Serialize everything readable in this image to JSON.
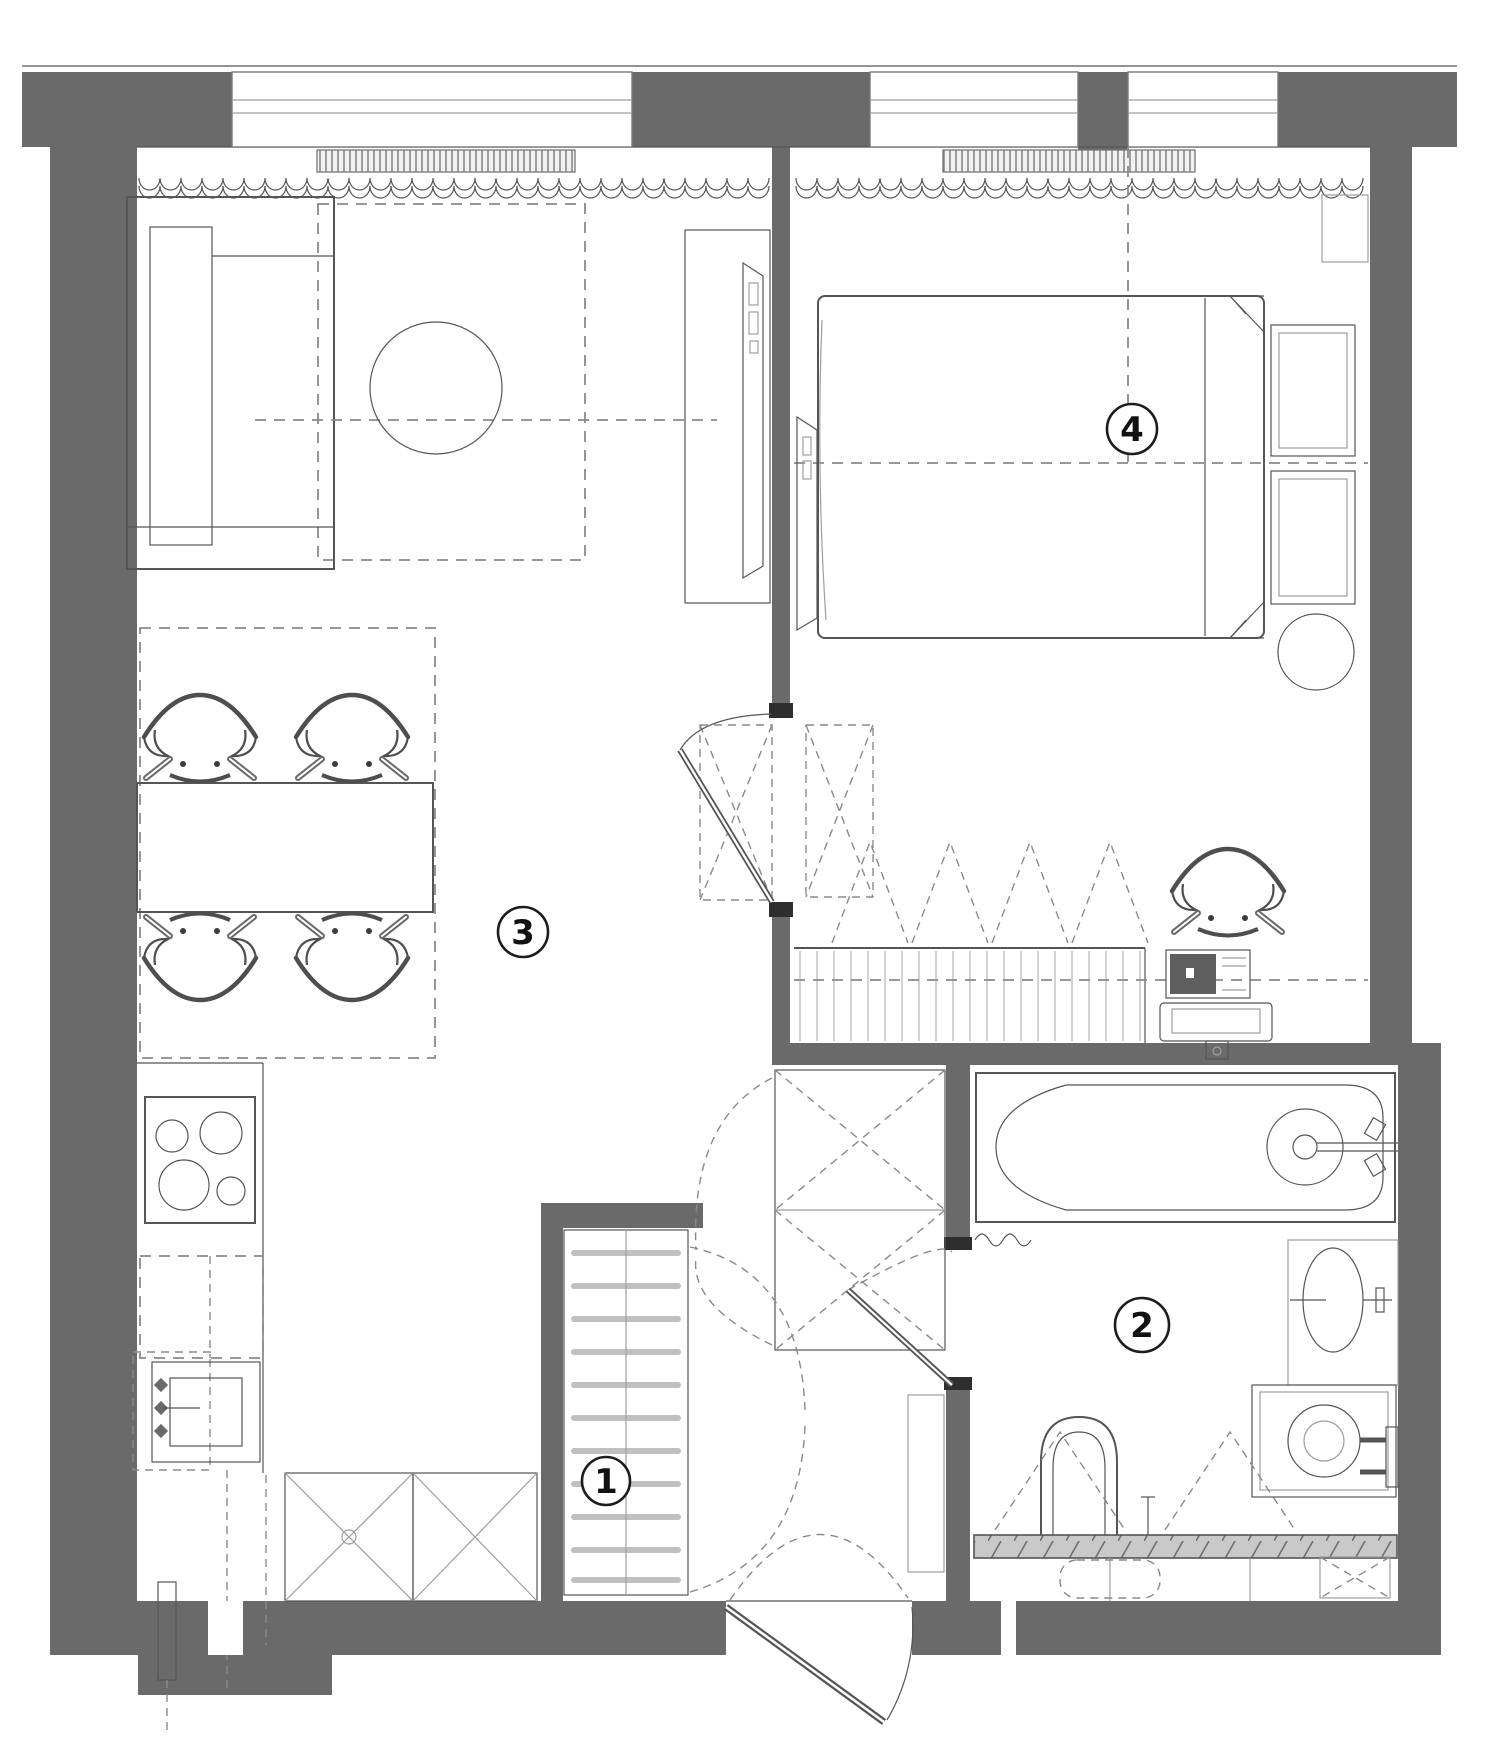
{
  "canvas": {
    "width": 1500,
    "height": 1737
  },
  "colors": {
    "wall": "#6a6a6a",
    "line_dark": "#3c3c3c",
    "line": "#555555",
    "line_light": "#9e9e9e",
    "dashed": "#8a8a8a",
    "paper": "#ffffff",
    "tile_fill": "#c9c9c9",
    "label_stroke": "#1d1d1d",
    "label_text": "#111111"
  },
  "room_labels": [
    {
      "id": "entrance-hall",
      "number": "1",
      "cx": 606,
      "cy": 1481,
      "r": 24
    },
    {
      "id": "bathroom",
      "number": "2",
      "cx": 1142,
      "cy": 1325,
      "r": 27
    },
    {
      "id": "living-kitchen",
      "number": "3",
      "cx": 523,
      "cy": 932,
      "r": 25
    },
    {
      "id": "bedroom",
      "number": "4",
      "cx": 1132,
      "cy": 429,
      "r": 25
    }
  ],
  "furniture_inventory": {
    "living_kitchen": [
      "sofa",
      "round-coffee-table",
      "tv-cabinet",
      "wall-tv",
      "dining-table",
      "dining-chairs-x4",
      "radiator",
      "curtain",
      "cooktop-4-burners",
      "kitchen-counter",
      "kitchen-sink",
      "tall-cabinets-x2"
    ],
    "bedroom": [
      "double-bed",
      "nightstand-shelves-x2",
      "round-side-table",
      "desk",
      "desk-chair",
      "monitor",
      "sliding-wardrobe",
      "wall-tv",
      "radiator",
      "curtain",
      "ac-unit"
    ],
    "bathroom": [
      "bathtub",
      "washbasin",
      "washing-machine",
      "towel-radiator",
      "toilet",
      "tiled-ledge"
    ],
    "entrance_hall": [
      "shoe-cabinet",
      "wardrobe-x",
      "console",
      "entrance-door"
    ]
  }
}
